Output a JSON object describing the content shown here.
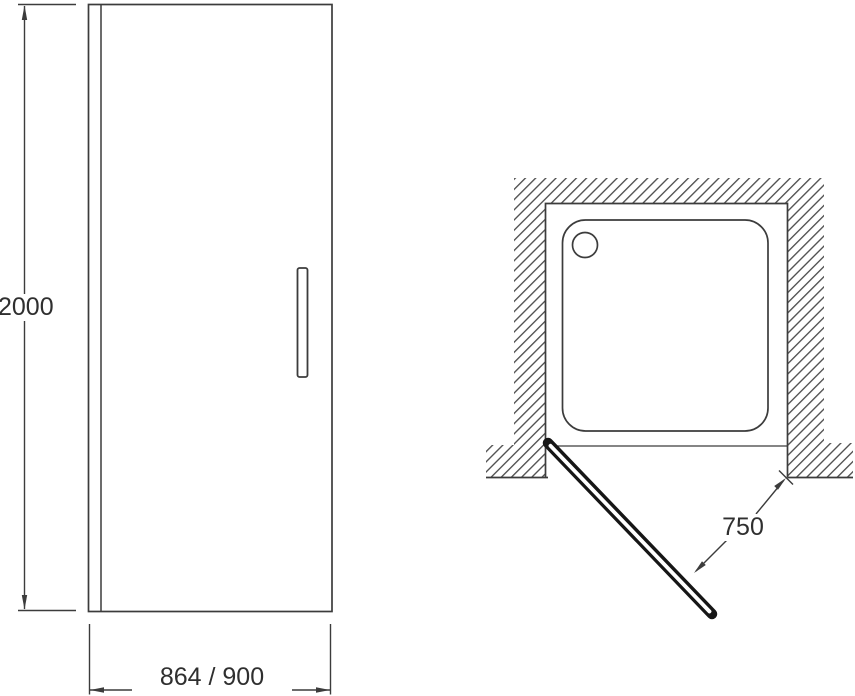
{
  "drawing": {
    "title": "shower-door-technical-drawing",
    "front_view": {
      "height_dimension": "2000",
      "width_dimension": "864 / 900"
    },
    "plan_view": {
      "opening_dimension": "750"
    }
  },
  "colors": {
    "line": "#3c3c3c",
    "hatch": "#4f4f4f",
    "door_outline": "#161616",
    "text": "#2f2f2f",
    "background": "#ffffff"
  }
}
